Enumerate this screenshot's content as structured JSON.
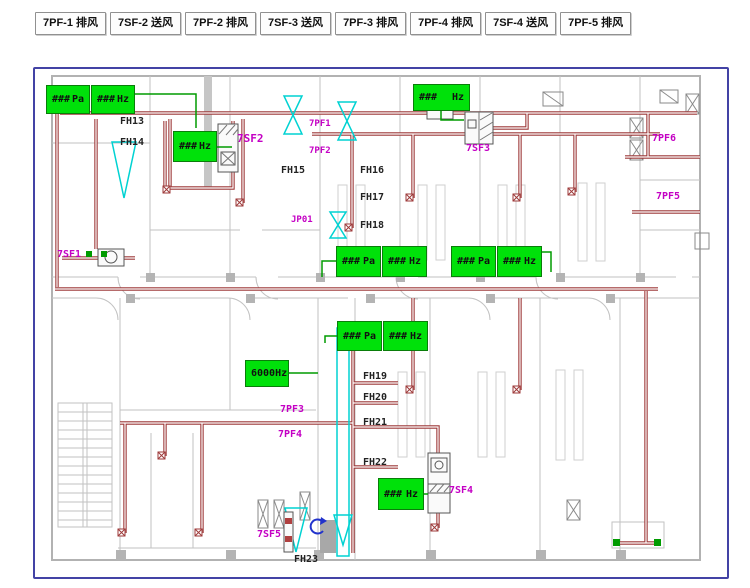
{
  "toolbar": {
    "buttons": [
      {
        "id": "7pf-1",
        "label": "7PF-1 排风"
      },
      {
        "id": "7sf-2",
        "label": "7SF-2 送风"
      },
      {
        "id": "7pf-2",
        "label": "7PF-2 排风"
      },
      {
        "id": "7sf-3",
        "label": "7SF-3 送风"
      },
      {
        "id": "7pf-3",
        "label": "7PF-3 排风"
      },
      {
        "id": "7pf-4",
        "label": "7PF-4 排风"
      },
      {
        "id": "7sf-4",
        "label": "7SF-4 送风"
      },
      {
        "id": "7pf-5",
        "label": "7PF-5 排风"
      }
    ]
  },
  "diagram": {
    "green_boxes": [
      {
        "value": "###",
        "unit": "Pa",
        "x": 46,
        "y": 85,
        "w": 44,
        "h": 29
      },
      {
        "value": "###",
        "unit": "Hz",
        "x": 91,
        "y": 85,
        "w": 44,
        "h": 29
      },
      {
        "value": "###",
        "unit": "Hz",
        "x": 173,
        "y": 131,
        "w": 44,
        "h": 31
      },
      {
        "value": "###",
        "unit": "Hz",
        "x": 413,
        "y": 84,
        "w": 57,
        "h": 27
      },
      {
        "value": "###",
        "unit": "Pa",
        "x": 336,
        "y": 246,
        "w": 45,
        "h": 31
      },
      {
        "value": "###",
        "unit": "Hz",
        "x": 382,
        "y": 246,
        "w": 45,
        "h": 31
      },
      {
        "value": "###",
        "unit": "Pa",
        "x": 451,
        "y": 246,
        "w": 45,
        "h": 31
      },
      {
        "value": "###",
        "unit": "Hz",
        "x": 497,
        "y": 246,
        "w": 45,
        "h": 31
      },
      {
        "value": "###",
        "unit": "Pa",
        "x": 337,
        "y": 321,
        "w": 45,
        "h": 30
      },
      {
        "value": "###",
        "unit": "Hz",
        "x": 383,
        "y": 321,
        "w": 45,
        "h": 30
      },
      {
        "value": "6000",
        "unit": "Hz",
        "x": 245,
        "y": 360,
        "w": 44,
        "h": 27
      },
      {
        "value": "###",
        "unit": "Hz",
        "x": 378,
        "y": 478,
        "w": 46,
        "h": 32
      }
    ],
    "fan_labels": [
      {
        "text": "7SF2",
        "x": 237,
        "y": 133,
        "size": 11
      },
      {
        "text": "7PF1",
        "x": 309,
        "y": 120,
        "size": 9
      },
      {
        "text": "7PF2",
        "x": 309,
        "y": 147,
        "size": 9
      },
      {
        "text": "JP01",
        "x": 291,
        "y": 216,
        "size": 9
      },
      {
        "text": "7SF3",
        "x": 466,
        "y": 144,
        "size": 10
      },
      {
        "text": "7PF6",
        "x": 652,
        "y": 134,
        "size": 10
      },
      {
        "text": "7PF5",
        "x": 656,
        "y": 192,
        "size": 10
      },
      {
        "text": "7SF1",
        "x": 57,
        "y": 250,
        "size": 10
      },
      {
        "text": "7PF3",
        "x": 280,
        "y": 405,
        "size": 10
      },
      {
        "text": "7PF4",
        "x": 278,
        "y": 430,
        "size": 10
      },
      {
        "text": "7SF4",
        "x": 449,
        "y": 486,
        "size": 10
      },
      {
        "text": "7SF5",
        "x": 257,
        "y": 530,
        "size": 10
      }
    ],
    "duct_labels": [
      {
        "text": "FH13",
        "x": 120,
        "y": 117
      },
      {
        "text": "FH14",
        "x": 120,
        "y": 138
      },
      {
        "text": "FH15",
        "x": 281,
        "y": 166
      },
      {
        "text": "FH16",
        "x": 360,
        "y": 166
      },
      {
        "text": "FH17",
        "x": 360,
        "y": 193
      },
      {
        "text": "FH18",
        "x": 360,
        "y": 221
      },
      {
        "text": "FH19",
        "x": 363,
        "y": 372
      },
      {
        "text": "FH20",
        "x": 363,
        "y": 393
      },
      {
        "text": "FH21",
        "x": 363,
        "y": 418
      },
      {
        "text": "FH22",
        "x": 363,
        "y": 458
      },
      {
        "text": "FH23",
        "x": 294,
        "y": 555
      }
    ],
    "colors": {
      "indicator_green": "#00e10a",
      "connector_green": "#009b00",
      "label_magenta": "#c400c4",
      "duct_red": "#9e3a3a",
      "highlight_cyan": "#00d2d2",
      "frame_blue": "#4343a5",
      "wall_gray": "#c2c2c2"
    }
  }
}
